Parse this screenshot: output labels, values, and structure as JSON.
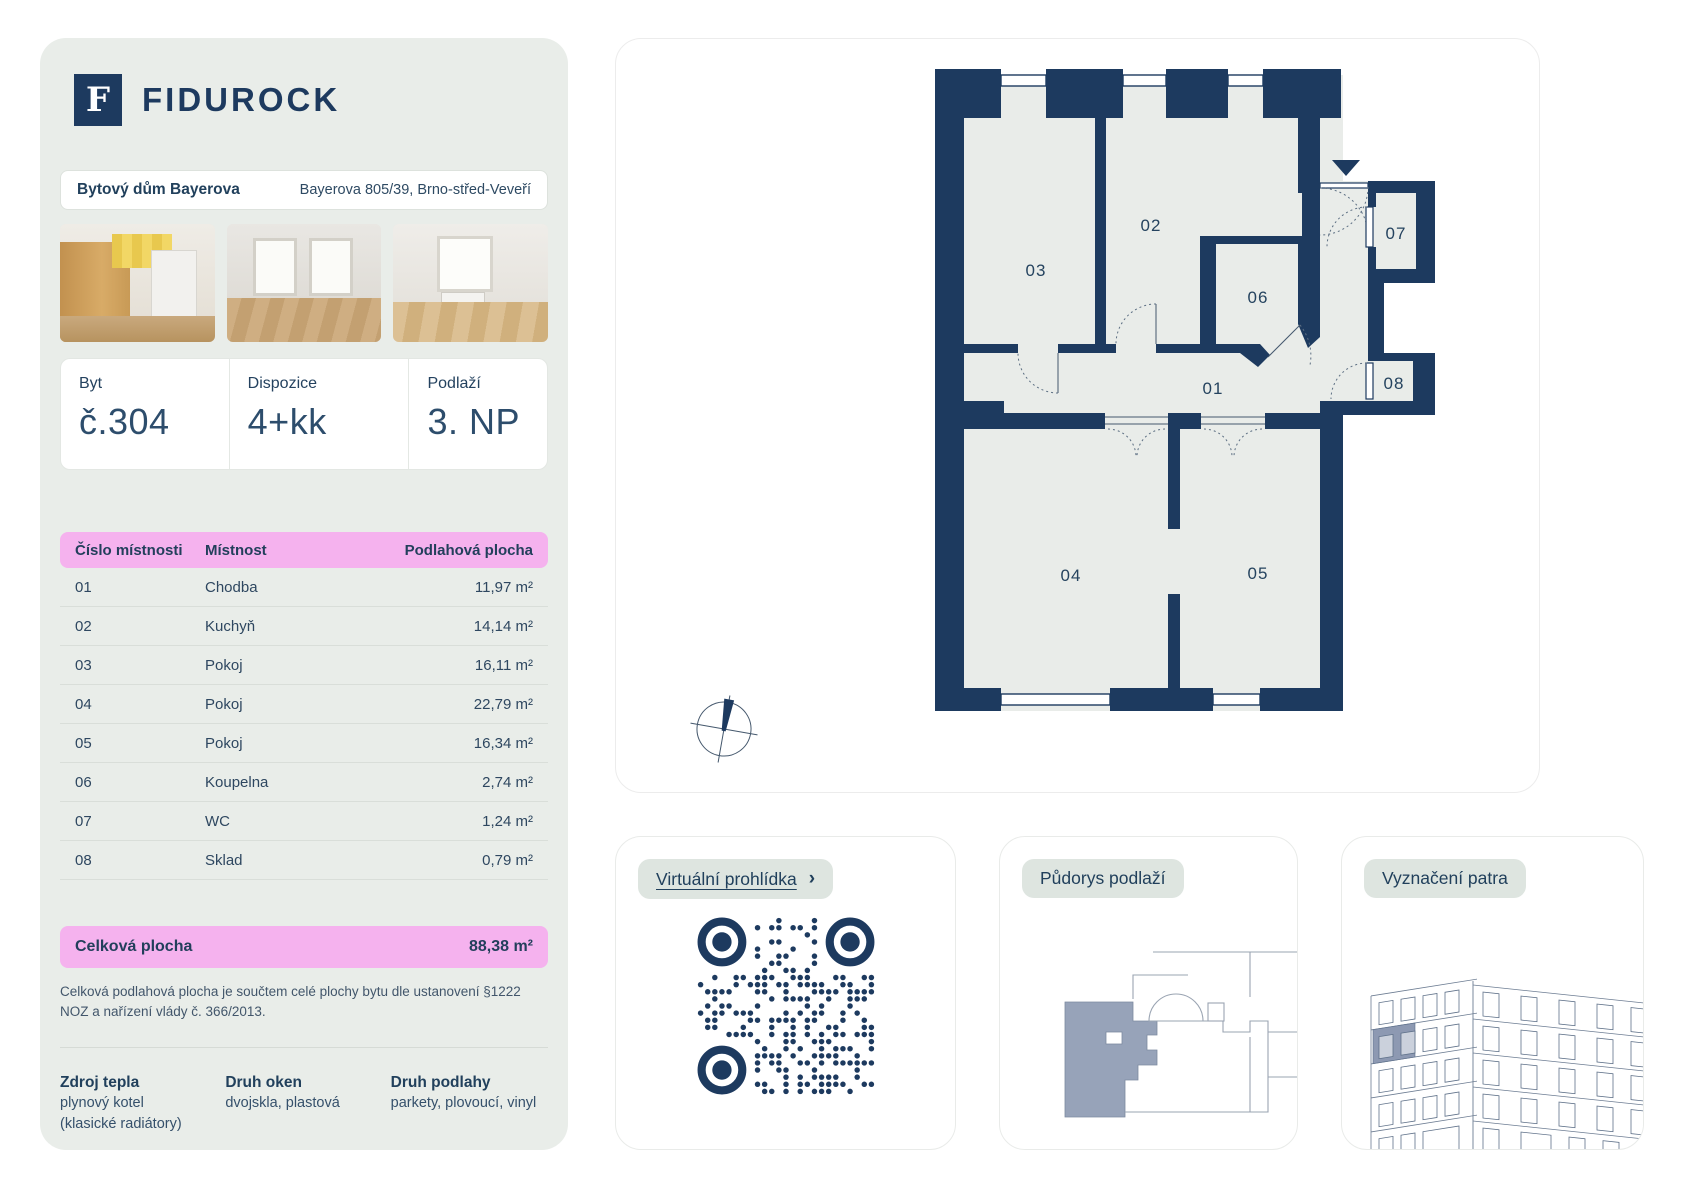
{
  "brand": {
    "name": "FIDUROCK",
    "logo_letter": "F"
  },
  "building": {
    "name": "Bytový dům Bayerova",
    "address": "Bayerova 805/39, Brno-střed-Veveří"
  },
  "unit": {
    "byt_label": "Byt",
    "byt_value": "č.304",
    "dispozice_label": "Dispozice",
    "dispozice_value": "4+kk",
    "podlazi_label": "Podlaží",
    "podlazi_value": "3. NP"
  },
  "rooms_table": {
    "headers": [
      "Číslo místnosti",
      "Místnost",
      "Podlahová plocha"
    ],
    "rows": [
      [
        "01",
        "Chodba",
        "11,97 m²"
      ],
      [
        "02",
        "Kuchyň",
        "14,14 m²"
      ],
      [
        "03",
        "Pokoj",
        "16,11 m²"
      ],
      [
        "04",
        "Pokoj",
        "22,79 m²"
      ],
      [
        "05",
        "Pokoj",
        "16,34 m²"
      ],
      [
        "06",
        "Koupelna",
        "2,74 m²"
      ],
      [
        "07",
        "WC",
        "1,24 m²"
      ],
      [
        "08",
        "Sklad",
        "0,79 m²"
      ]
    ],
    "total_label": "Celková plocha",
    "total_value": "88,38 m²",
    "footnote": "Celková podlahová plocha je součtem celé plochy bytu dle ustanovení §1222 NOZ a nařízení vlády č. 366/2013."
  },
  "details": [
    {
      "label": "Zdroj tepla",
      "lines": [
        "plynový kotel",
        "(klasické radiátory)"
      ]
    },
    {
      "label": "Druh oken",
      "lines": [
        "dvojskla, plastová",
        ""
      ]
    },
    {
      "label": "Druh podlahy",
      "lines": [
        "parkety, plovoucí, vinyl",
        ""
      ]
    }
  ],
  "floorplan": {
    "room_labels": [
      "01",
      "02",
      "03",
      "04",
      "05",
      "06",
      "07",
      "08"
    ]
  },
  "cards": {
    "virtual_tour_label": "Virtuální prohlídka",
    "virtual_tour_arrow": "›",
    "floor_outline_label": "Půdorys podlaží",
    "floor_marking_label": "Vyznačení patra"
  },
  "colors": {
    "navy": "#1d3a5f",
    "pink": "#f5b2ee",
    "card_bg": "#e9ede9",
    "highlight_gray_blue": "#97a3b9"
  }
}
